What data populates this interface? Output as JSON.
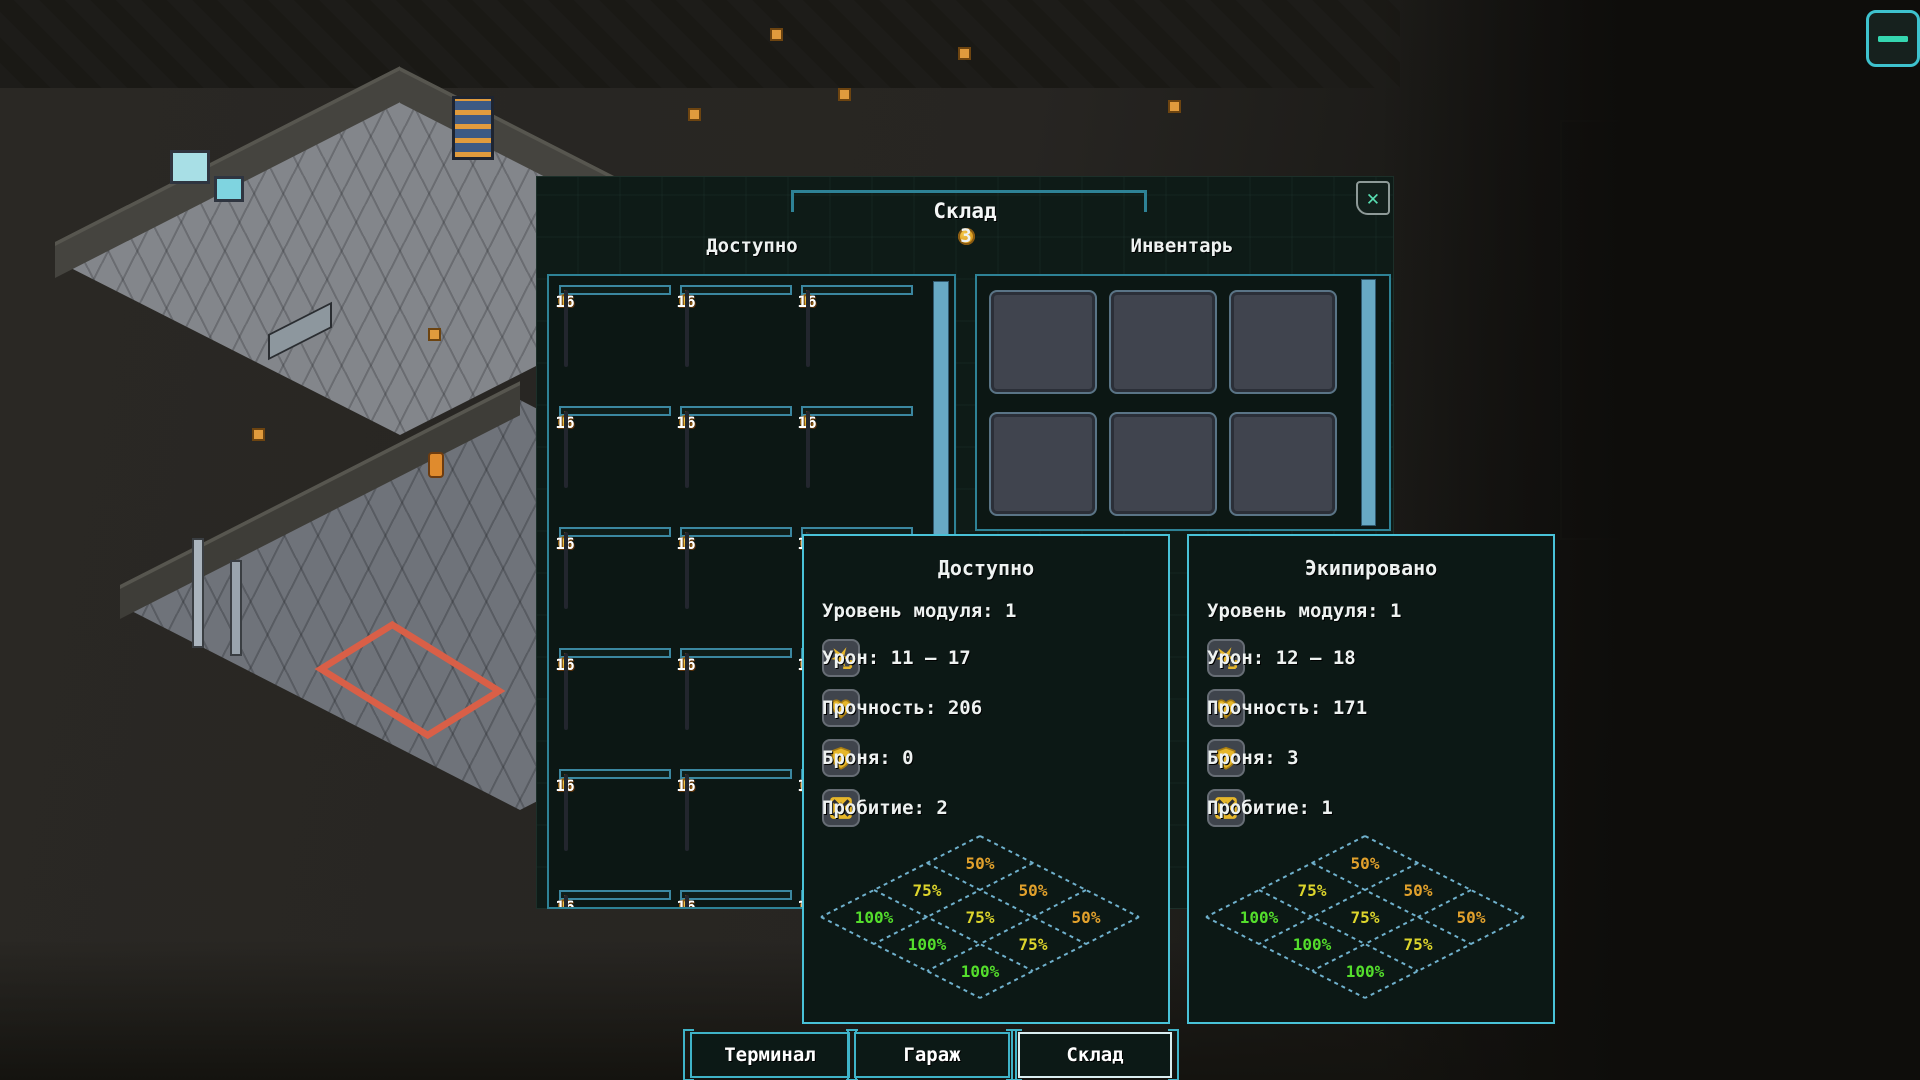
{
  "colors": {
    "accent_teal": "#49c2d8",
    "border_teal": "#2e8296",
    "price_orange": "#b5691f",
    "scroll_blue": "#68a9c4",
    "green": "#54de2c",
    "yellow": "#ddd52c",
    "orange": "#e2a12c",
    "close_x": "#58dfb2"
  },
  "menu_button": {
    "icon": "hamburger-icon"
  },
  "dialog": {
    "title": "Склад",
    "close_glyph": "✕",
    "coins": "3",
    "available_header": "Доступно",
    "inventory_header": "Инвентарь",
    "store": {
      "item_price": "16",
      "item_count": "1",
      "rows": [
        [
          "assault-drone",
          "assault-drone",
          "assault-drone"
        ],
        [
          "missile-turret-red",
          "heavy-mech-orange",
          "walker-module"
        ],
        [
          "rocket-pod",
          "minigun-turret",
          "covered"
        ],
        [
          "minigun-turret",
          "minigun-turret",
          "covered"
        ],
        [
          "missile-launcher-orange",
          "minigun-turret",
          "covered"
        ],
        [
          "covered",
          "covered",
          "covered"
        ]
      ]
    },
    "inventory_slots": 6
  },
  "panels": [
    {
      "title": "Доступно",
      "level": "Уровень модуля: 1",
      "stats": [
        {
          "icon": "damage-icon",
          "label": "Урон: 11 – 17"
        },
        {
          "icon": "durability-icon",
          "label": "Прочность: 206"
        },
        {
          "icon": "armor-icon",
          "label": "Броня: 0"
        },
        {
          "icon": "penetration-icon",
          "label": "Пробитие: 2"
        }
      ],
      "efficiency_cells": [
        {
          "i": 0,
          "j": 0,
          "label": "50%",
          "color": "#e2a12c"
        },
        {
          "i": 1,
          "j": 0,
          "label": "50%",
          "color": "#e2a12c"
        },
        {
          "i": 2,
          "j": 0,
          "label": "50%",
          "color": "#e2a12c"
        },
        {
          "i": 0,
          "j": 1,
          "label": "75%",
          "color": "#ddd52c"
        },
        {
          "i": 1,
          "j": 1,
          "label": "75%",
          "color": "#ddd52c"
        },
        {
          "i": 2,
          "j": 1,
          "label": "75%",
          "color": "#ddd52c"
        },
        {
          "i": 0,
          "j": 2,
          "label": "100%",
          "color": "#54de2c"
        },
        {
          "i": 1,
          "j": 2,
          "label": "100%",
          "color": "#54de2c"
        },
        {
          "i": 2,
          "j": 2,
          "label": "100%",
          "color": "#54de2c"
        }
      ]
    },
    {
      "title": "Экипировано",
      "level": "Уровень модуля: 1",
      "stats": [
        {
          "icon": "damage-icon",
          "label": "Урон: 12 – 18"
        },
        {
          "icon": "durability-icon",
          "label": "Прочность: 171"
        },
        {
          "icon": "armor-icon",
          "label": "Броня: 3"
        },
        {
          "icon": "penetration-icon",
          "label": "Пробитие: 1"
        }
      ],
      "efficiency_cells": [
        {
          "i": 0,
          "j": 0,
          "label": "50%",
          "color": "#e2a12c"
        },
        {
          "i": 1,
          "j": 0,
          "label": "50%",
          "color": "#e2a12c"
        },
        {
          "i": 2,
          "j": 0,
          "label": "50%",
          "color": "#e2a12c"
        },
        {
          "i": 0,
          "j": 1,
          "label": "75%",
          "color": "#ddd52c"
        },
        {
          "i": 1,
          "j": 1,
          "label": "75%",
          "color": "#ddd52c"
        },
        {
          "i": 2,
          "j": 1,
          "label": "75%",
          "color": "#ddd52c"
        },
        {
          "i": 0,
          "j": 2,
          "label": "100%",
          "color": "#54de2c"
        },
        {
          "i": 1,
          "j": 2,
          "label": "100%",
          "color": "#54de2c"
        },
        {
          "i": 2,
          "j": 2,
          "label": "100%",
          "color": "#54de2c"
        }
      ]
    }
  ],
  "bottom_buttons": [
    {
      "key": "terminal",
      "label": "Терминал",
      "active": false
    },
    {
      "key": "garage",
      "label": "Гараж",
      "active": false
    },
    {
      "key": "warehouse",
      "label": "Склад",
      "active": true
    }
  ]
}
